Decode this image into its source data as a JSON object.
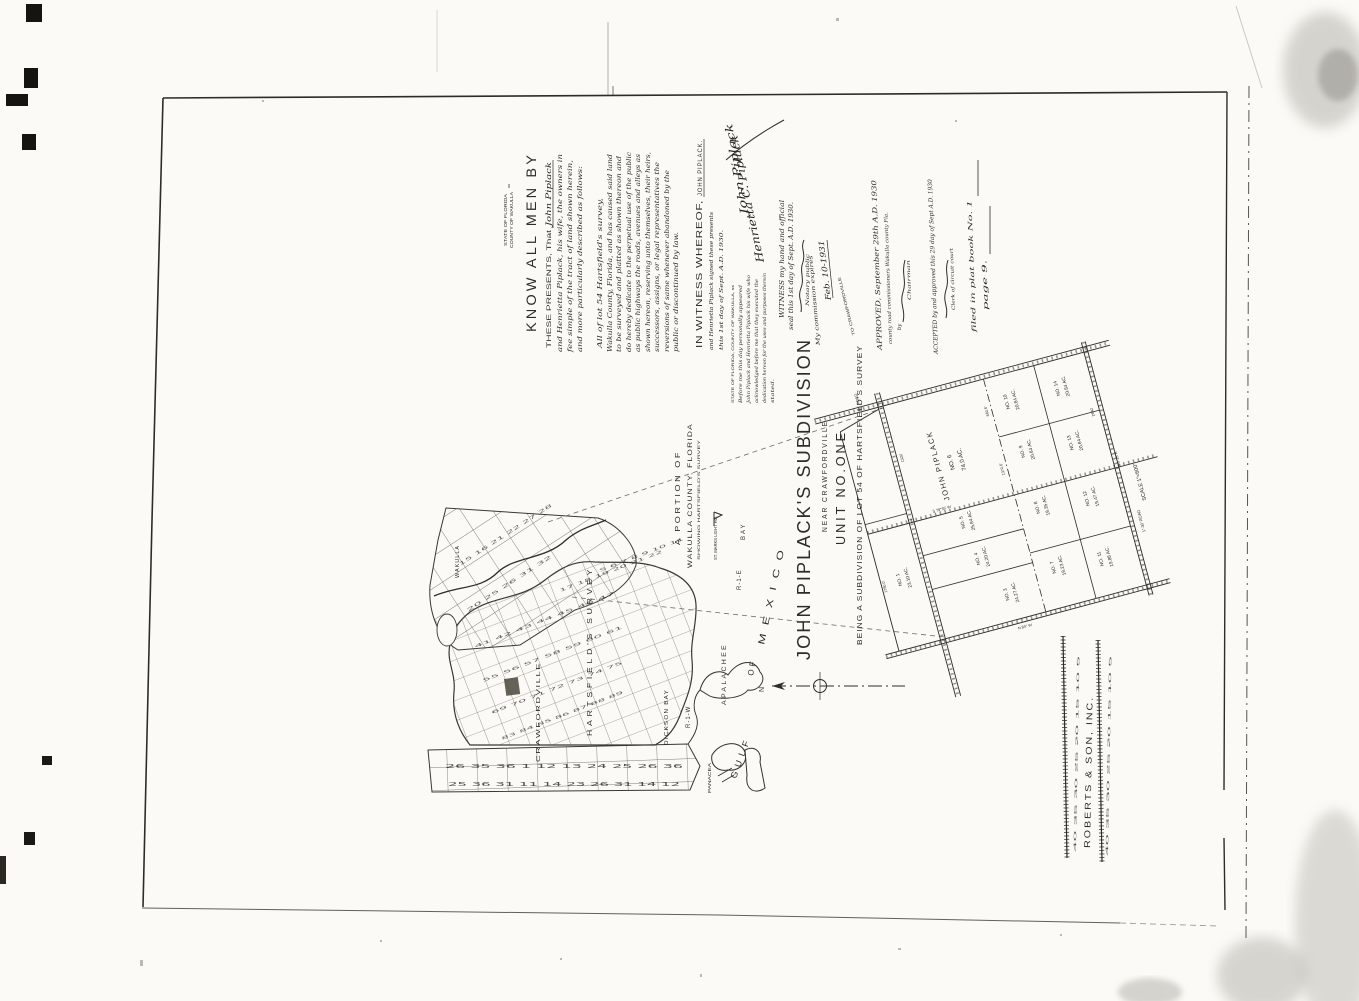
{
  "deed": {
    "venue_state": "STATE OF FLORIDA",
    "venue_county": "COUNTY OF WAKULLA",
    "venue_ss": "ss",
    "heading": "KNOW ALL MEN BY",
    "presents_line": "THESE PRESENTS, That",
    "presents_name": "John Piplack",
    "lines": [
      "and Henrietta Piplack, his wife, the owners in",
      "fee simple of the tract of land shown herein,",
      "and more particularly described as follows:"
    ],
    "parcel_intro": "All of lot 54 Hartsfield's survey,",
    "body_lines": [
      "Wakulla County, Florida, and has caused said land",
      "to be surveyed and platted as shown thereon and",
      "do hereby dedicate to the perpetual use of the public",
      "as public highways the roads, avenues and alleys as",
      "shown hereon, reserving unto themselves, their heirs,",
      "successors, assigns, or legal representatives the",
      "reversions of same whenever abandoned by the",
      "public or discontinued by law."
    ],
    "witness_heading": "IN WITNESS WHEREOF,",
    "witness_name": "JOHN PIPLACK.",
    "witness_lines": [
      "and Henrietta Piplack signed these presents",
      "this 1st day of Sept. A.D. 1930."
    ],
    "signature_1": "John Piplack",
    "signature_2": "Henrietta C. Piplack",
    "jurat_venue": "STATE OF FLORIDA, COUNTY OF WAKULLA, ss",
    "jurat_lines": [
      "Before me this day personally appeared",
      "John Piplack and Henrietta Piplack his wife who",
      "acknowledged before me that they executed the",
      "dedication hereon for the uses and purposes therein",
      "stated."
    ],
    "seal_line_1": "WITNESS my hand and official",
    "seal_line_2": "seal this 1st day of Sept. A.D. 1930.",
    "notary_title": "Notary public",
    "commission_line": "My commission expires",
    "commission_date": "Feb. 10-1931"
  },
  "approval": {
    "approved_line": "APPROVED, September 29th A.D. 1930",
    "board_line": "county road commissioners Wakulla county Fla.",
    "by_label": "by",
    "chairman_label": "Chairman",
    "accepted_line": "ACCEPTED by and approved this 29 day of Sept A.D. 1930",
    "clerk_label": "Clerk of circuit court",
    "filed_line": "filed in plat book No. 1",
    "page_line": "page 9."
  },
  "title_block": {
    "title": "JOHN PIPLACK'S SUBDIVISION",
    "subtitle": "NEAR CRAWFORDVILLE",
    "unit": "UNIT NO.ONE",
    "being": "BEING A SUBDIVISION OF LOT 54 OF HARTSFIELD'S SURVEY",
    "north_label": "N",
    "road_note": "TO CRAWFORDVILLE"
  },
  "overview_map": {
    "caption_1": "A PORTION OF",
    "caption_2": "WAKULLA COUNTY, FLORIDA",
    "caption_3": "SHOWING HARTSFIELD'S SURVEY",
    "labels": {
      "wakulla": "WAKULLA",
      "hartsfield": "HARTSFIELD'S SURVEY",
      "crawfordville": "CRAWFORDVILLE",
      "st_marks": "ST. MARKS LIGHT HO.",
      "r1e": "R-1-E",
      "r1w": "R-1-W",
      "dickson": "DICKSON BAY",
      "panacea": "PANACEA",
      "bay": "BAY",
      "gulf": "GULF",
      "of": "OF",
      "mexico": "MEXICO",
      "apalachee": "APALACHEE"
    },
    "grid_numbers": {
      "dense_1": "41 42 43 44 45 46 47",
      "dense_2": "55 56 57 58 59 60 61",
      "dense_3": "69 70 71 72 73 74 75",
      "dense_4": "83 84 85 86 87 88 89",
      "dense_5": "17 18 19 20 21 22",
      "dense_6": "5 6 7 8 9 10 11",
      "coarse_1": "15 16 21 22 27 28",
      "coarse_2": "20 25 26 31 32",
      "strip_1": "26 35 36 1 12 13 24 25 26 36",
      "strip_2": "25 36 31 11 14 23 26 31 14 12"
    }
  },
  "plat": {
    "scale_note": "SCALE 1\"=600'",
    "roads": {
      "top": "30' ROAD",
      "right": "1\"-30' ROAD"
    },
    "bearings": [
      "S 6°25' E",
      "N 84° W",
      "S 79°35' W"
    ],
    "dims": [
      "1320'",
      "660.6'",
      "1370.6'",
      "1780.0'",
      "2640'"
    ],
    "lots": [
      {
        "no": "NO. 6",
        "area": "74.0 AC.",
        "owner": "JOHN PIPLACK"
      },
      {
        "no": "NO. 5",
        "area": "25.84 AC."
      },
      {
        "no": "NO. 4",
        "area": "24.20 AC."
      },
      {
        "no": "NO. 3",
        "area": "24.27 AC."
      },
      {
        "no": "NO. 1",
        "area": "23.10 AC."
      },
      {
        "no": "NO. 10",
        "area": "20.84 AC."
      },
      {
        "no": "NO. 14",
        "area": "20.84 AC."
      },
      {
        "no": "NO. 9",
        "area": "20.84 AC."
      },
      {
        "no": "NO. 13",
        "area": "20.84 AC."
      },
      {
        "no": "NO. 8",
        "area": "19.35 AC."
      },
      {
        "no": "NO. 12",
        "area": "19.47 AC."
      },
      {
        "no": "NO. 7",
        "area": "19.23 AC."
      },
      {
        "no": "NO. 11",
        "area": "19.88 AC."
      }
    ]
  },
  "surveyor": {
    "name": "ROBERTS & SON, INC.",
    "ruler_numbers": "40 35 30 25 20 15 10 5"
  },
  "record": {
    "book_label": "filed in plat book No. 1",
    "page_label": "page 9."
  }
}
